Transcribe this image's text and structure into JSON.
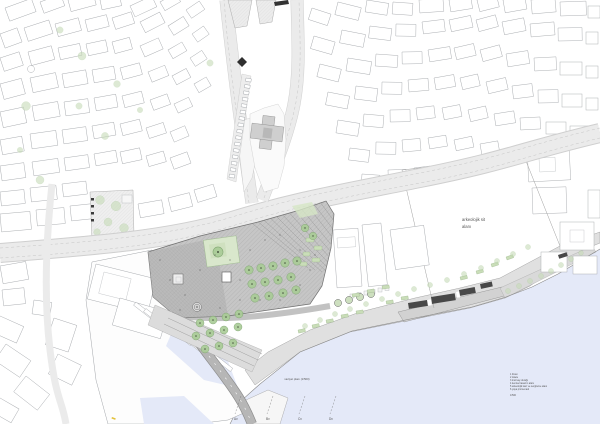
{
  "map": {
    "labels": {
      "archaeological_site_line1": "arkeolojik sit",
      "archaeological_site_line2": "alanı",
      "plan_caption": "vaziyet planı (1/500)"
    },
    "section_markers": [
      "Av",
      "Bv",
      "Cv",
      "Dv"
    ],
    "legend": {
      "items": [
        "1   liman",
        "2   iskele",
        "3   tramvay durağı",
        "4   kentsel tasarım alanı",
        "5   arkeolojik kazı ve sergileme alanı",
        "6   yaya promenadı"
      ],
      "scale_label": "1/500"
    },
    "colors": {
      "water": "#e4e9f8",
      "road": "#ebebeb",
      "road-dark": "#b6b6b6",
      "plaza": "#c6c6c6",
      "plaza-dark": "#b0b0b0",
      "tree": "#c7dcb8",
      "tree-dark": "#a9cc96",
      "lawn": "#d9e7cc",
      "structure": "#484848",
      "building-stroke": "#a6a9ad"
    }
  }
}
